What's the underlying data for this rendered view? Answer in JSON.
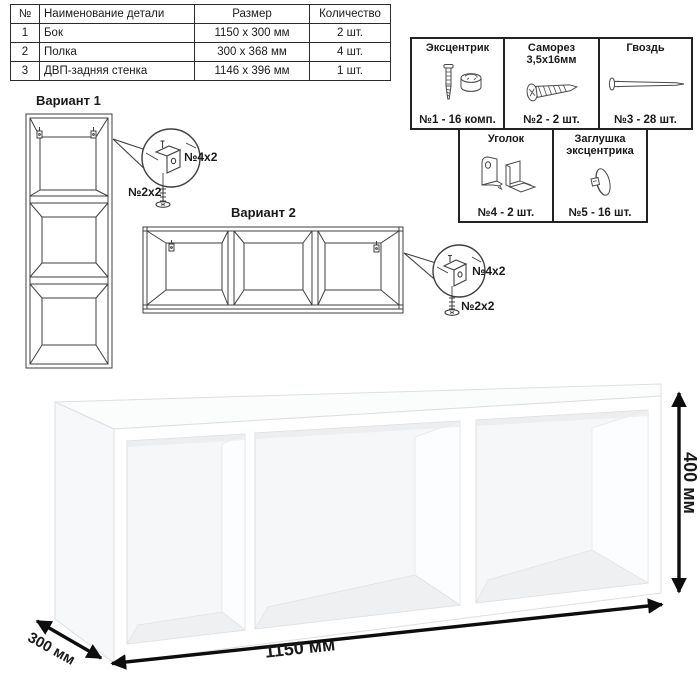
{
  "table": {
    "headers": {
      "num": "№",
      "name": "Наименование детали",
      "size": "Размер",
      "qty": "Количество"
    },
    "rows": [
      {
        "num": "1",
        "name": "Бок",
        "size": "1150 x 300 мм",
        "qty": "2 шт."
      },
      {
        "num": "2",
        "name": "Полка",
        "size": "300 x 368 мм",
        "qty": "4 шт."
      },
      {
        "num": "3",
        "name": "ДВП-задняя стенка",
        "size": "1146 x 396 мм",
        "qty": "1 шт."
      }
    ]
  },
  "hardware": {
    "eccentric": {
      "title": "Эксцентрик",
      "count": "№1 - 16 комп.",
      "icon": "eccentric-cam-icon"
    },
    "screw": {
      "title": "Саморез",
      "subtitle": "3,5х16мм",
      "count": "№2 - 2 шт.",
      "icon": "screw-icon"
    },
    "nail": {
      "title": "Гвоздь",
      "count": "№3 - 28 шт.",
      "icon": "nail-icon"
    },
    "bracket": {
      "title": "Уголок",
      "count": "№4 - 2 шт.",
      "icon": "corner-bracket-icon"
    },
    "cap": {
      "title": "Заглушка",
      "subtitle": "эксцентрика",
      "count": "№5 - 16 шт.",
      "icon": "cam-cover-icon"
    }
  },
  "variant1": {
    "title": "Вариант 1",
    "bracket_label": "№4х2",
    "screw_label": "№2х2"
  },
  "variant2": {
    "title": "Вариант 2",
    "bracket_label": "№4х2",
    "screw_label": "№2х2"
  },
  "dimensions": {
    "width": "1150 мм",
    "depth": "300 мм",
    "height": "400 мм"
  },
  "colors": {
    "ink": "#1a1a1a",
    "line_art": "#3f3f3f",
    "arrow": "#0d0d0d",
    "shelf_back": "#f6f7f8",
    "shelf_floor": "#eef0f2",
    "edge": "#dcdfe1"
  }
}
